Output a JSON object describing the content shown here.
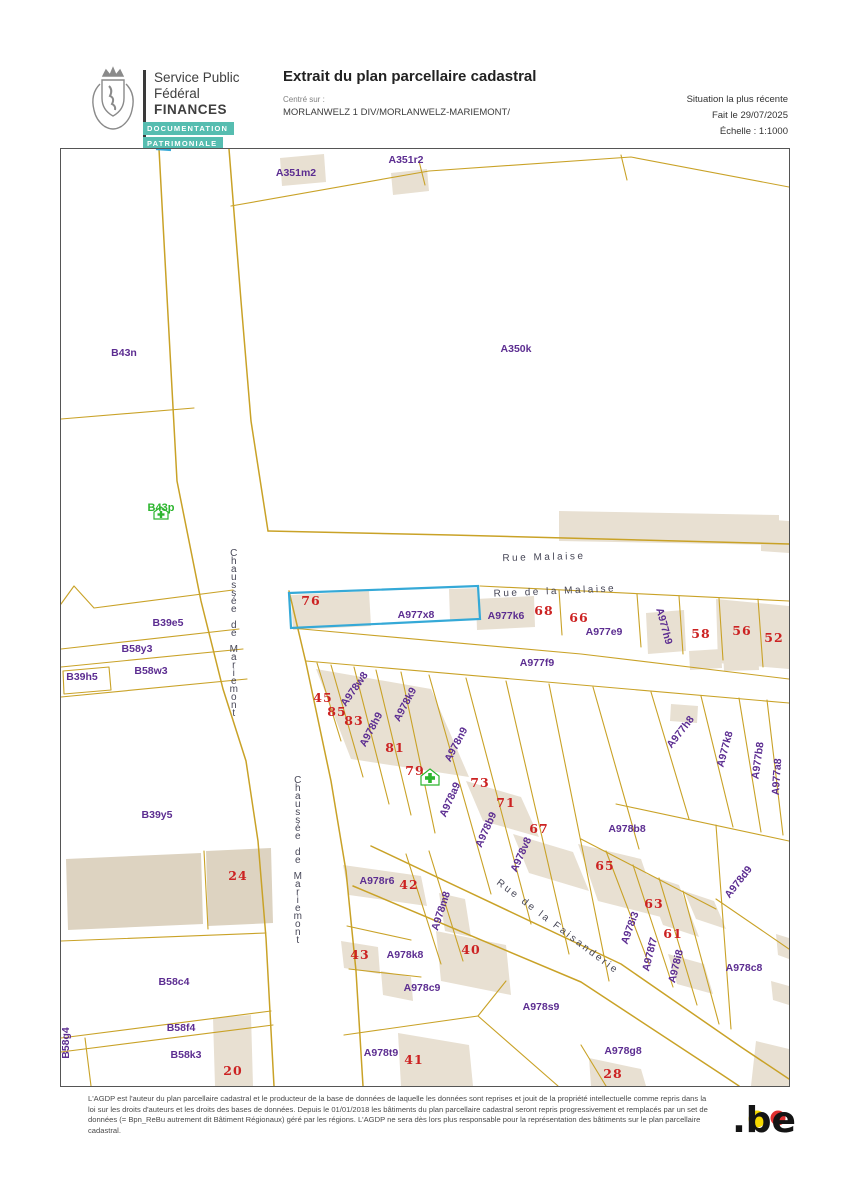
{
  "header": {
    "agency_line1": "Service Public",
    "agency_line2": "Fédéral",
    "agency_line3": "FINANCES",
    "badge1": "DOCUMENTATION",
    "badge2": "PATRIMONIALE",
    "title": "Extrait du plan parcellaire cadastral",
    "centered_on_label": "Centré sur :",
    "centered_on_value": "MORLANWELZ 1 DIV/MORLANWELZ-MARIEMONT/",
    "situation": "Situation la plus récente",
    "date": "Fait le 29/07/2025",
    "scale": "Échelle : 1:1000"
  },
  "map": {
    "highlighted_parcel": "A977x8",
    "labels": [
      {
        "t": "A351m2",
        "x": 235,
        "y": 27,
        "k": "parcel"
      },
      {
        "t": "A351r2",
        "x": 345,
        "y": 14,
        "k": "parcel"
      },
      {
        "t": "A350k",
        "x": 455,
        "y": 203,
        "k": "parcel"
      },
      {
        "t": "B43n",
        "x": 63,
        "y": 207,
        "k": "parcel"
      },
      {
        "t": "B39e5",
        "x": 107,
        "y": 477,
        "k": "parcel"
      },
      {
        "t": "B58y3",
        "x": 76,
        "y": 503,
        "k": "parcel"
      },
      {
        "t": "B39h5",
        "x": 21,
        "y": 531,
        "k": "parcel"
      },
      {
        "t": "B58w3",
        "x": 90,
        "y": 525,
        "k": "parcel"
      },
      {
        "t": "B39y5",
        "x": 96,
        "y": 669,
        "k": "parcel"
      },
      {
        "t": "B58c4",
        "x": 113,
        "y": 836,
        "k": "parcel"
      },
      {
        "t": "B58f4",
        "x": 120,
        "y": 882,
        "k": "parcel"
      },
      {
        "t": "B58g4",
        "x": 8,
        "y": 894,
        "k": "parcel",
        "r": -90
      },
      {
        "t": "B58k3",
        "x": 125,
        "y": 909,
        "k": "parcel"
      },
      {
        "t": "A977x8",
        "x": 355,
        "y": 469,
        "k": "parcel"
      },
      {
        "t": "A977k6",
        "x": 445,
        "y": 470,
        "k": "parcel"
      },
      {
        "t": "A977e9",
        "x": 543,
        "y": 486,
        "k": "parcel"
      },
      {
        "t": "A977h9",
        "x": 600,
        "y": 478,
        "k": "parcel",
        "r": 75
      },
      {
        "t": "A977f9",
        "x": 476,
        "y": 517,
        "k": "parcel"
      },
      {
        "t": "A977h8",
        "x": 622,
        "y": 585,
        "k": "parcel",
        "r": -52
      },
      {
        "t": "A977k8",
        "x": 667,
        "y": 601,
        "k": "parcel",
        "r": -75
      },
      {
        "t": "A977b8",
        "x": 700,
        "y": 612,
        "k": "parcel",
        "r": -82
      },
      {
        "t": "A977a8",
        "x": 719,
        "y": 628,
        "k": "parcel",
        "r": -86
      },
      {
        "t": "A978w8",
        "x": 296,
        "y": 542,
        "k": "parcel",
        "r": -55
      },
      {
        "t": "A978h9",
        "x": 313,
        "y": 582,
        "k": "parcel",
        "r": -62
      },
      {
        "t": "A978k9",
        "x": 347,
        "y": 557,
        "k": "parcel",
        "r": -62
      },
      {
        "t": "A978n9",
        "x": 398,
        "y": 597,
        "k": "parcel",
        "r": -62
      },
      {
        "t": "A978a9",
        "x": 392,
        "y": 652,
        "k": "parcel",
        "r": -66
      },
      {
        "t": "A978b9",
        "x": 428,
        "y": 682,
        "k": "parcel",
        "r": -66
      },
      {
        "t": "A978v8",
        "x": 463,
        "y": 707,
        "k": "parcel",
        "r": -66
      },
      {
        "t": "A978b8",
        "x": 566,
        "y": 683,
        "k": "parcel"
      },
      {
        "t": "A978r6",
        "x": 316,
        "y": 735,
        "k": "parcel"
      },
      {
        "t": "A978m8",
        "x": 383,
        "y": 763,
        "k": "parcel",
        "r": -72
      },
      {
        "t": "A978k8",
        "x": 344,
        "y": 809,
        "k": "parcel"
      },
      {
        "t": "A978c9",
        "x": 361,
        "y": 842,
        "k": "parcel"
      },
      {
        "t": "A978s9",
        "x": 480,
        "y": 861,
        "k": "parcel"
      },
      {
        "t": "A978t9",
        "x": 320,
        "y": 907,
        "k": "parcel"
      },
      {
        "t": "A978g8",
        "x": 562,
        "y": 905,
        "k": "parcel"
      },
      {
        "t": "A978i3",
        "x": 572,
        "y": 780,
        "k": "parcel",
        "r": -70
      },
      {
        "t": "A978f7",
        "x": 592,
        "y": 806,
        "k": "parcel",
        "r": -76
      },
      {
        "t": "A978i8",
        "x": 618,
        "y": 818,
        "k": "parcel",
        "r": -76
      },
      {
        "t": "A978d9",
        "x": 680,
        "y": 735,
        "k": "parcel",
        "r": -52
      },
      {
        "t": "A978c8",
        "x": 683,
        "y": 822,
        "k": "parcel"
      },
      {
        "t": "B43p",
        "x": 100,
        "y": 362,
        "k": "green"
      },
      {
        "t": "76",
        "x": 250,
        "y": 456,
        "k": "number"
      },
      {
        "t": "68",
        "x": 483,
        "y": 466,
        "k": "number"
      },
      {
        "t": "66",
        "x": 518,
        "y": 473,
        "k": "number"
      },
      {
        "t": "58",
        "x": 640,
        "y": 489,
        "k": "number"
      },
      {
        "t": "56",
        "x": 681,
        "y": 486,
        "k": "number"
      },
      {
        "t": "52",
        "x": 713,
        "y": 493,
        "k": "number"
      },
      {
        "t": "45",
        "x": 262,
        "y": 553,
        "k": "number"
      },
      {
        "t": "85",
        "x": 276,
        "y": 567,
        "k": "number"
      },
      {
        "t": "83",
        "x": 293,
        "y": 576,
        "k": "number"
      },
      {
        "t": "81",
        "x": 334,
        "y": 603,
        "k": "number"
      },
      {
        "t": "79",
        "x": 354,
        "y": 626,
        "k": "number"
      },
      {
        "t": "73",
        "x": 419,
        "y": 638,
        "k": "number"
      },
      {
        "t": "71",
        "x": 445,
        "y": 658,
        "k": "number"
      },
      {
        "t": "67",
        "x": 478,
        "y": 684,
        "k": "number"
      },
      {
        "t": "65",
        "x": 544,
        "y": 721,
        "k": "number"
      },
      {
        "t": "63",
        "x": 593,
        "y": 759,
        "k": "number"
      },
      {
        "t": "61",
        "x": 612,
        "y": 789,
        "k": "number"
      },
      {
        "t": "42",
        "x": 348,
        "y": 740,
        "k": "number"
      },
      {
        "t": "43",
        "x": 299,
        "y": 810,
        "k": "number"
      },
      {
        "t": "40",
        "x": 410,
        "y": 805,
        "k": "number"
      },
      {
        "t": "41",
        "x": 353,
        "y": 915,
        "k": "number"
      },
      {
        "t": "28",
        "x": 552,
        "y": 929,
        "k": "number"
      },
      {
        "t": "24",
        "x": 177,
        "y": 731,
        "k": "number"
      },
      {
        "t": "20",
        "x": 172,
        "y": 926,
        "k": "number"
      },
      {
        "t": "Rue Malaise",
        "x": 483,
        "y": 411,
        "k": "street",
        "r": -1.5
      },
      {
        "t": "Rue de la Malaise",
        "x": 494,
        "y": 445,
        "k": "street",
        "r": -2.5
      },
      {
        "t": "Chaussée de Mariemont",
        "x": 174,
        "y": 487,
        "k": "street",
        "stack": true
      },
      {
        "t": "Chaussée de Mariemont",
        "x": 238,
        "y": 714,
        "k": "street",
        "stack": true
      },
      {
        "t": "Rue de la Faisanderie",
        "x": 495,
        "y": 780,
        "k": "street",
        "r": 37
      }
    ]
  },
  "footer": {
    "disclaimer": "L'AGDP est l'auteur du plan parcellaire cadastral et le producteur de la base de données de laquelle les données sont reprises et jouit de la propriété intellectuelle comme repris dans la loi sur les droits d'auteurs et les droits des bases de données. Depuis le 01/01/2018 les bâtiments du plan parcellaire cadastral seront repris progressivement et remplacés par un set de données (= Bpn_ReBu autrement dit Bâtiment Régionaux) géré par les régions. L'AGDP ne sera dès lors plus responsable pour la représentation des bâtiments sur le plan parcellaire cadastral.",
    "logo_text": ".be"
  },
  "colors": {
    "parcel": "#5c2d91",
    "number": "#cc2222",
    "street": "#474757",
    "boundary": "#c9a227",
    "building": "#e8e0d2",
    "building_dark": "#ddd3c1",
    "highlight": "#35a9d7",
    "green": "#2db52f",
    "badge_teal": "#56bdb0",
    "logo_yellow": "#f5d800",
    "logo_red": "#e03030"
  }
}
